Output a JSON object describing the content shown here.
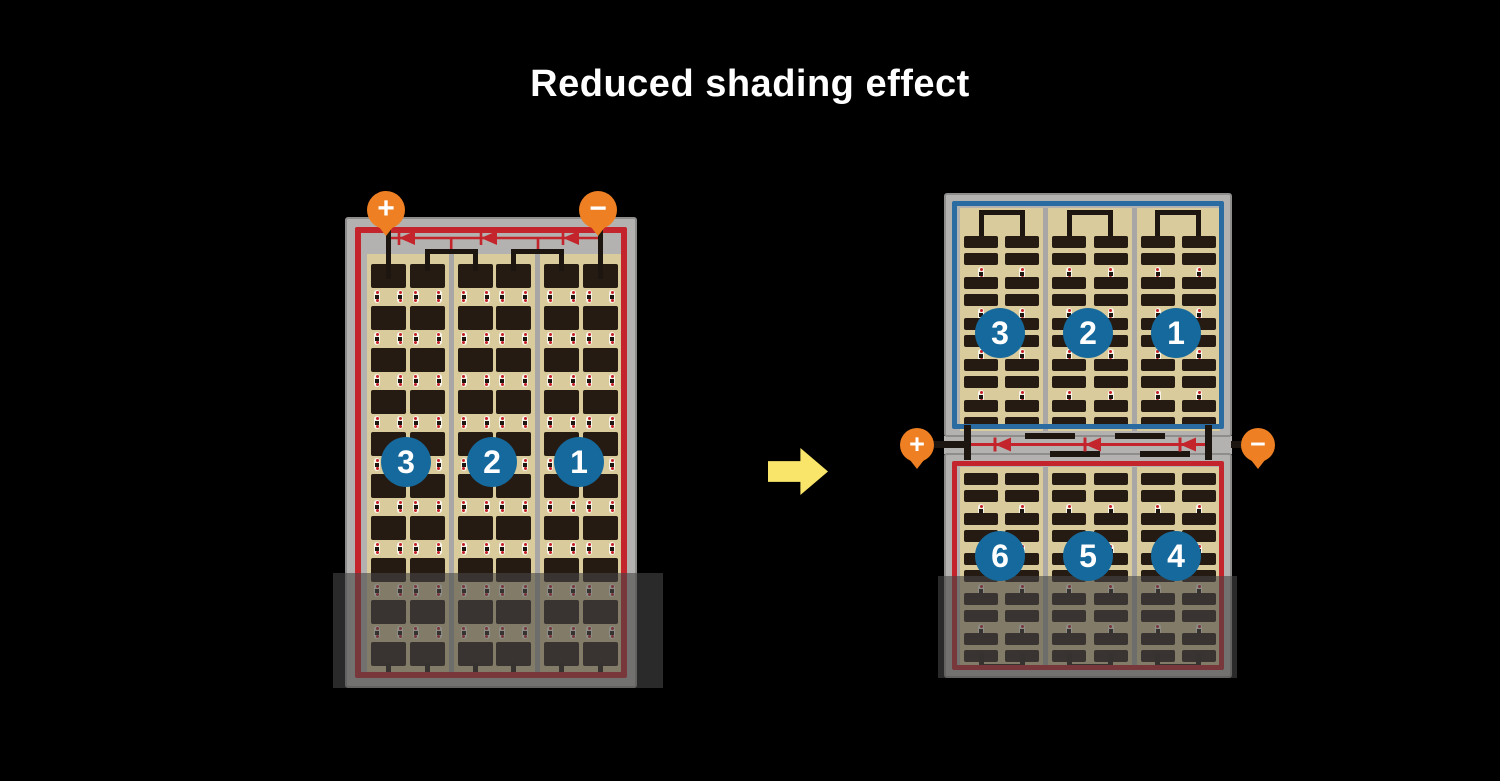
{
  "title": "Reduced shading effect",
  "colors": {
    "background": "#000000",
    "frame_gray": "#b3b2b0",
    "frame_edge": "#8e8d8b",
    "divider_gray": "#a8a7a6",
    "backsheet_tan": "#d9cb9c",
    "cell_dark": "#261b13",
    "busbar_black": "#1d150f",
    "circuit_red": "#c4242b",
    "circuit_blue": "#2a6ca2",
    "badge_blue": "#15699c",
    "terminal_orange": "#ee7f22",
    "arrow_yellow": "#f8e56a",
    "dot_red": "#c42127",
    "shade": "rgba(70,70,70,0.6)"
  },
  "left_module": {
    "cell_rows": 10,
    "cell_cols": 6,
    "groups": 3,
    "bypass_diodes": 3,
    "group_labels": [
      "3",
      "2",
      "1"
    ],
    "terminals": [
      {
        "sign": "+"
      },
      {
        "sign": "−"
      }
    ]
  },
  "right_assembly": {
    "top": {
      "border": "blue",
      "cell_rows": 10,
      "cell_cols": 6,
      "group_labels": [
        "3",
        "2",
        "1"
      ]
    },
    "bottom": {
      "border": "red",
      "cell_rows": 10,
      "cell_cols": 6,
      "group_labels": [
        "6",
        "5",
        "4"
      ]
    },
    "bypass_diodes": 3,
    "terminals": [
      {
        "sign": "+"
      },
      {
        "sign": "−"
      }
    ]
  }
}
